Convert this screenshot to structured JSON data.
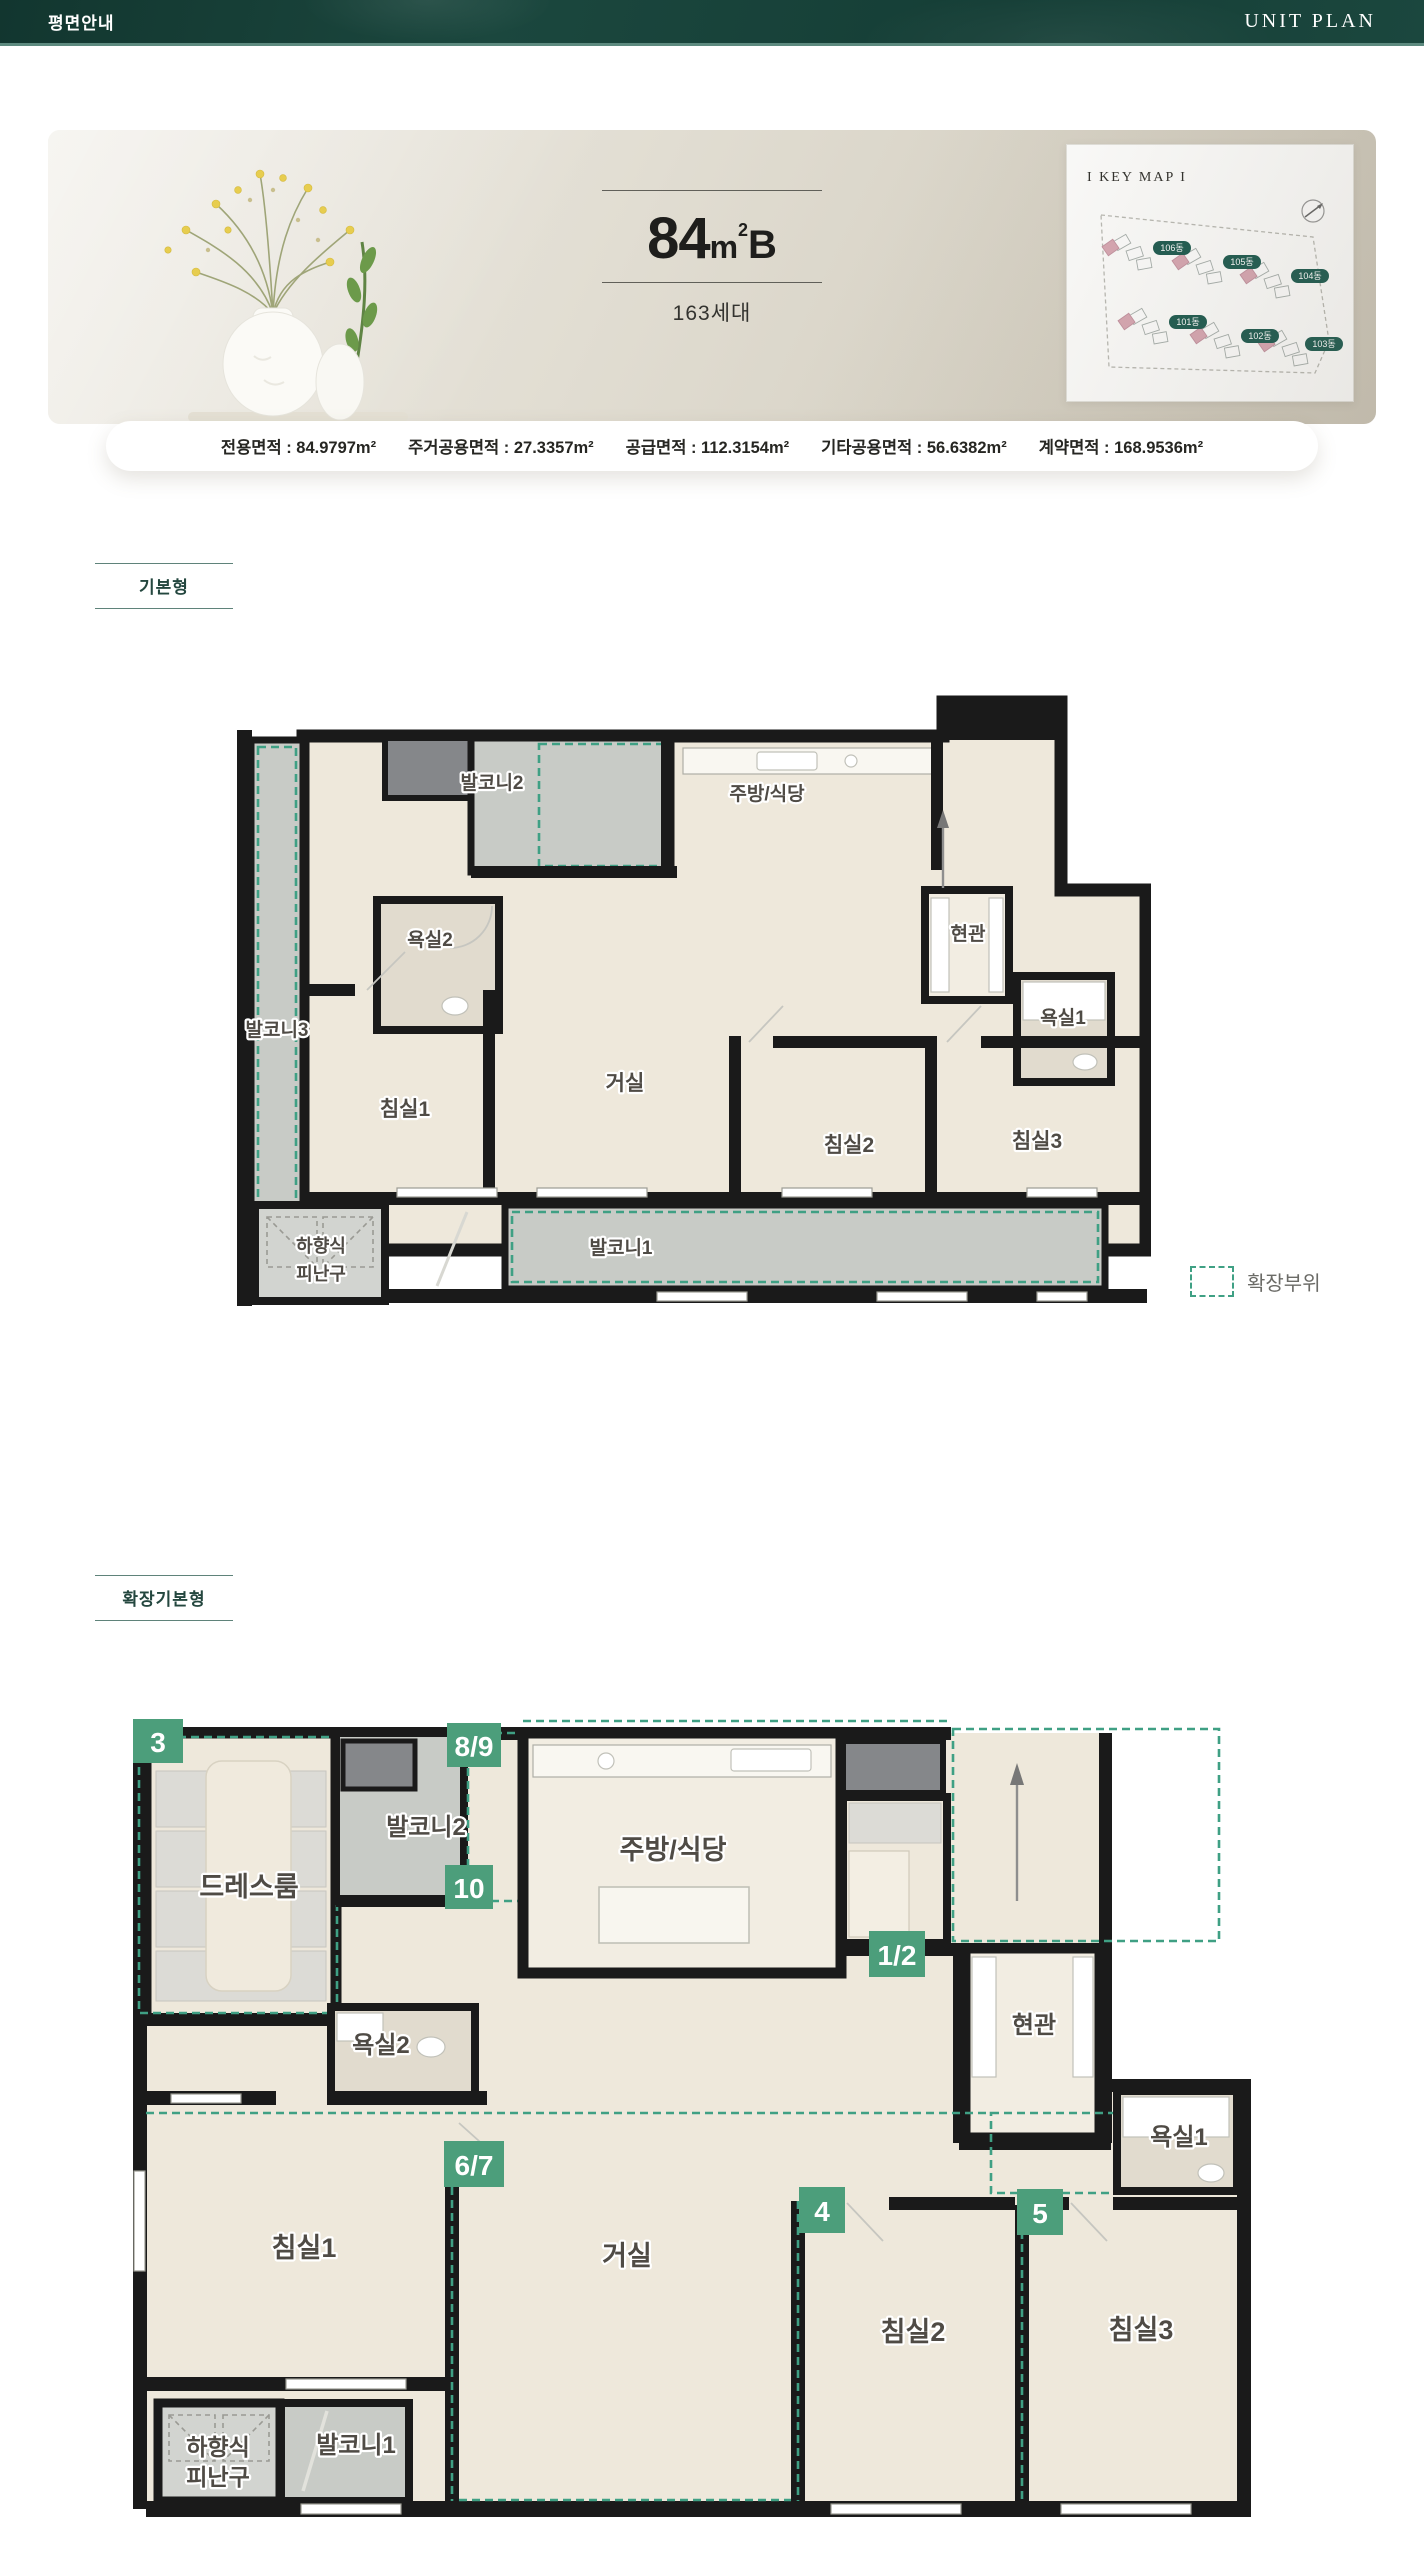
{
  "header": {
    "title_left": "평면안내",
    "title_right": "UNIT PLAN"
  },
  "hero": {
    "size_number": "84",
    "size_unit": "m",
    "size_sup": "2",
    "size_type": "B",
    "households": "163세대",
    "keymap": {
      "title": "I KEY MAP I",
      "buildings": [
        "106동",
        "105동",
        "104동",
        "101동",
        "102동",
        "103동"
      ]
    }
  },
  "area_bar": {
    "items": [
      "전용면적 : 84.9797m²",
      "주거공용면적 : 27.3357m²",
      "공급면적 : 112.3154m²",
      "기타공용면적 : 56.6382m²",
      "계약면적 : 168.9536m²"
    ]
  },
  "sections": {
    "basic": "기본형",
    "extended": "확장기본형"
  },
  "legend": {
    "label": "확장부위"
  },
  "plan_basic": {
    "rooms": {
      "balcony2": "발코니2",
      "kitchen": "주방/식당",
      "bath2": "욕실2",
      "entrance": "현관",
      "bath1": "욕실1",
      "balcony3": "발코니3",
      "bed1": "침실1",
      "living": "거실",
      "bed2": "침실2",
      "bed3": "침실3",
      "balcony1": "발코니1",
      "escape_line1": "하향식",
      "escape_line2": "피난구"
    }
  },
  "plan_extended": {
    "rooms": {
      "dress": "드레스룸",
      "balcony2": "발코니2",
      "kitchen": "주방/식당",
      "bath2": "욕실2",
      "entrance": "현관",
      "bath1": "욕실1",
      "bed1": "침실1",
      "living": "거실",
      "bed2": "침실2",
      "bed3": "침실3",
      "balcony1": "발코니1",
      "escape_line1": "하향식",
      "escape_line2": "피난구"
    },
    "badges": {
      "b3": "3",
      "b89": "8/9",
      "b10": "10",
      "b12": "1/2",
      "b67": "6/7",
      "b4": "4",
      "b5": "5"
    }
  },
  "colors": {
    "accent_teal": "#16443C",
    "badge_green": "#4C9E7B",
    "dash_green": "#3FA084"
  }
}
